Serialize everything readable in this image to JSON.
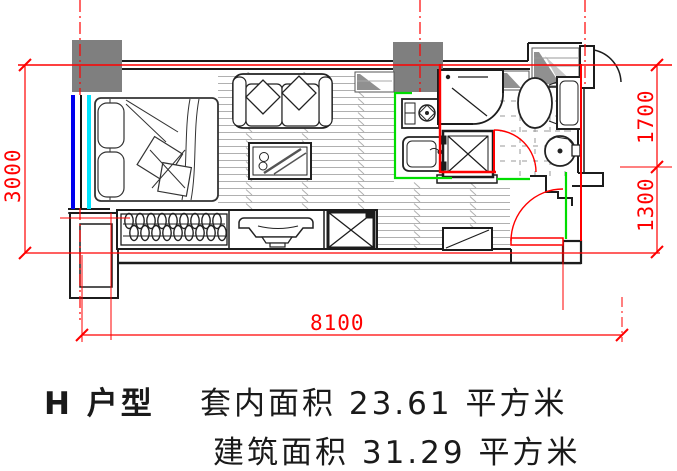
{
  "floor_plan": {
    "dimensions": {
      "left_mm": "3000",
      "right_upper_mm": "1700",
      "right_lower_mm": "1300",
      "bottom_mm": "8100"
    },
    "colors": {
      "dimension_red": "#ff0000",
      "partition_green": "#00dd00",
      "window_blue": "#0000ee",
      "window_cyan": "#00e5ff",
      "column_gray": "#7f7f7f",
      "wall_black": "#1c1c1c"
    }
  },
  "caption": {
    "unit": "H 户型",
    "line1": "套内面积 23.61 平方米",
    "line2": "建筑面积 31.29 平方米"
  }
}
